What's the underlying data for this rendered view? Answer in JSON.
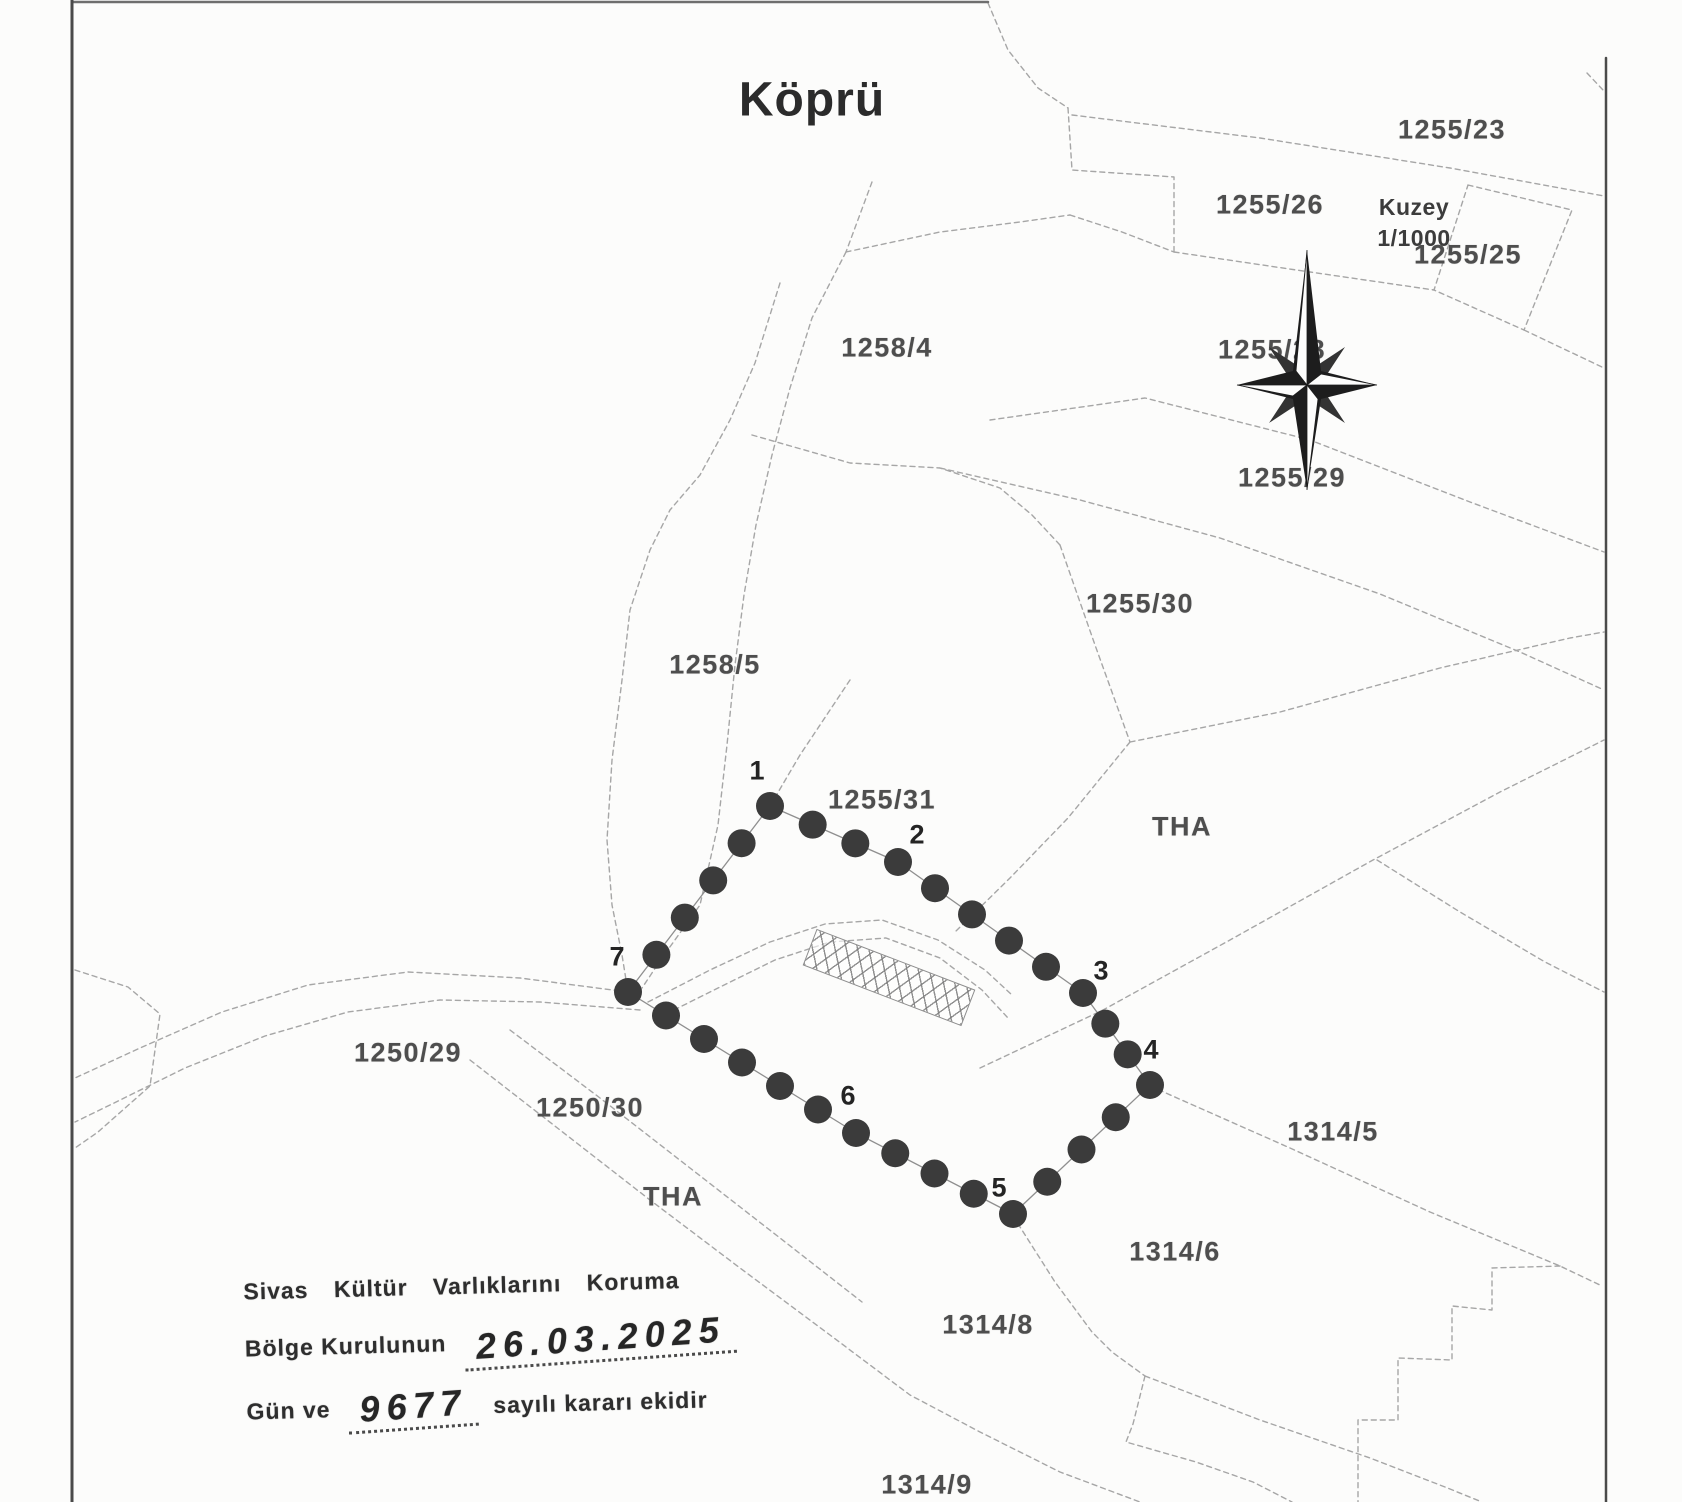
{
  "title": "Köprü",
  "compass": {
    "label": "Kuzey",
    "scale": "1/1000",
    "cx": 1307,
    "cy": 385,
    "label_x": 1414,
    "label_y": 192
  },
  "parcel_labels": [
    {
      "label": "1255/23",
      "x": 1452,
      "y": 130
    },
    {
      "label": "1255/26",
      "x": 1270,
      "y": 205
    },
    {
      "label": "1255/25",
      "x": 1468,
      "y": 255
    },
    {
      "label": "1255/28",
      "x": 1272,
      "y": 350
    },
    {
      "label": "1255/29",
      "x": 1292,
      "y": 478
    },
    {
      "label": "1255/30",
      "x": 1140,
      "y": 604
    },
    {
      "label": "1258/4",
      "x": 887,
      "y": 348
    },
    {
      "label": "1258/5",
      "x": 715,
      "y": 665
    },
    {
      "label": "1255/31",
      "x": 882,
      "y": 800
    },
    {
      "label": "THA",
      "x": 1182,
      "y": 827
    },
    {
      "label": "1250/29",
      "x": 408,
      "y": 1053
    },
    {
      "label": "1250/30",
      "x": 590,
      "y": 1108
    },
    {
      "label": "THA",
      "x": 673,
      "y": 1197
    },
    {
      "label": "1314/5",
      "x": 1333,
      "y": 1132
    },
    {
      "label": "1314/6",
      "x": 1175,
      "y": 1252
    },
    {
      "label": "1314/8",
      "x": 988,
      "y": 1325
    },
    {
      "label": "1314/9",
      "x": 927,
      "y": 1485
    }
  ],
  "site_polygon": {
    "vertices": [
      {
        "n": "1",
        "x": 770,
        "y": 806,
        "lx": 757,
        "ly": 771
      },
      {
        "n": "2",
        "x": 898,
        "y": 862,
        "lx": 917,
        "ly": 835
      },
      {
        "n": "3",
        "x": 1083,
        "y": 993,
        "lx": 1101,
        "ly": 971
      },
      {
        "n": "4",
        "x": 1150,
        "y": 1085,
        "lx": 1151,
        "ly": 1050
      },
      {
        "n": "5",
        "x": 1013,
        "y": 1214,
        "lx": 999,
        "ly": 1188
      },
      {
        "n": "6",
        "x": 856,
        "y": 1133,
        "lx": 848,
        "ly": 1096
      },
      {
        "n": "7",
        "x": 628,
        "y": 992,
        "lx": 617,
        "ly": 957
      }
    ],
    "mid_counts": [
      2,
      4,
      2,
      3,
      3,
      5,
      4
    ],
    "dot_radius": 14
  },
  "bridge": {
    "cx": 888,
    "cy": 976,
    "length": 168,
    "width": 37,
    "angle_deg": 21
  },
  "stamp": {
    "line1": "Sivas Kültür Varlıklarını Koruma",
    "line2_prefix": "Bölge Kurulunun",
    "line2_hand": "26.03.2025",
    "line3_prefix": "Gün ve",
    "line3_hand": "9677",
    "line3_suffix": "sayılı kararı ekidir",
    "x": 245,
    "y": 1272
  },
  "colors": {
    "paper": "#fcfcfb",
    "boundary_line": "#a6a6a6",
    "frame_line": "#4a4a4a",
    "dot": "#3b3b3b",
    "polygon_line": "#8f8f8f",
    "label_text": "#4e4e4e",
    "stamp_text": "#2e2e2e",
    "compass_dark": "#1d1d1d"
  },
  "frame": {
    "left": [
      [
        72,
        0
      ],
      [
        72,
        1502
      ]
    ],
    "top": [
      [
        72,
        2
      ],
      [
        988,
        2
      ]
    ],
    "right": [
      [
        1606,
        58
      ],
      [
        1606,
        1502
      ]
    ]
  },
  "boundaries": [
    [
      [
        988,
        3
      ],
      [
        1008,
        50
      ],
      [
        1038,
        88
      ],
      [
        1068,
        108
      ]
    ],
    [
      [
        1068,
        108
      ],
      [
        1072,
        170
      ],
      [
        1174,
        177
      ],
      [
        1174,
        252
      ]
    ],
    [
      [
        1072,
        115
      ],
      [
        1260,
        138
      ],
      [
        1450,
        168
      ],
      [
        1604,
        196
      ]
    ],
    [
      [
        1174,
        252
      ],
      [
        1310,
        272
      ],
      [
        1434,
        290
      ]
    ],
    [
      [
        1468,
        185
      ],
      [
        1572,
        210
      ],
      [
        1524,
        330
      ],
      [
        1434,
        290
      ],
      [
        1468,
        185
      ]
    ],
    [
      [
        1524,
        330
      ],
      [
        1604,
        368
      ]
    ],
    [
      [
        990,
        420
      ],
      [
        1145,
        398
      ],
      [
        1310,
        440
      ],
      [
        1470,
        502
      ],
      [
        1604,
        552
      ]
    ],
    [
      [
        940,
        468
      ],
      [
        1080,
        500
      ],
      [
        1220,
        538
      ],
      [
        1380,
        594
      ],
      [
        1520,
        652
      ],
      [
        1604,
        690
      ]
    ],
    [
      [
        1060,
        545
      ],
      [
        1095,
        645
      ],
      [
        1130,
        742
      ]
    ],
    [
      [
        1130,
        742
      ],
      [
        1280,
        712
      ],
      [
        1440,
        668
      ],
      [
        1570,
        638
      ],
      [
        1604,
        632
      ]
    ],
    [
      [
        1130,
        742
      ],
      [
        1068,
        818
      ],
      [
        1010,
        878
      ],
      [
        955,
        932
      ]
    ],
    [
      [
        780,
        283
      ],
      [
        755,
        363
      ],
      [
        730,
        420
      ],
      [
        700,
        475
      ],
      [
        670,
        510
      ],
      [
        650,
        550
      ],
      [
        630,
        610
      ],
      [
        622,
        680
      ],
      [
        612,
        760
      ],
      [
        607,
        840
      ],
      [
        612,
        905
      ],
      [
        622,
        955
      ],
      [
        628,
        992
      ]
    ],
    [
      [
        846,
        252
      ],
      [
        812,
        318
      ],
      [
        790,
        388
      ],
      [
        772,
        455
      ],
      [
        756,
        525
      ],
      [
        744,
        595
      ],
      [
        735,
        665
      ],
      [
        727,
        745
      ],
      [
        718,
        825
      ],
      [
        700,
        905
      ],
      [
        662,
        958
      ],
      [
        642,
        988
      ]
    ],
    [
      [
        872,
        182
      ],
      [
        846,
        252
      ]
    ],
    [
      [
        846,
        252
      ],
      [
        940,
        232
      ],
      [
        1020,
        222
      ],
      [
        1070,
        215
      ]
    ],
    [
      [
        1070,
        215
      ],
      [
        1122,
        232
      ],
      [
        1174,
        252
      ]
    ],
    [
      [
        752,
        435
      ],
      [
        850,
        463
      ],
      [
        940,
        468
      ],
      [
        1000,
        488
      ],
      [
        1032,
        515
      ],
      [
        1060,
        545
      ]
    ],
    [
      [
        850,
        680
      ],
      [
        830,
        710
      ],
      [
        800,
        755
      ],
      [
        770,
        806
      ]
    ],
    [
      [
        628,
        992
      ],
      [
        520,
        978
      ],
      [
        408,
        972
      ],
      [
        308,
        985
      ],
      [
        222,
        1012
      ],
      [
        140,
        1048
      ],
      [
        75,
        1078
      ]
    ],
    [
      [
        640,
        1010
      ],
      [
        540,
        1002
      ],
      [
        440,
        1000
      ],
      [
        348,
        1012
      ],
      [
        265,
        1036
      ],
      [
        185,
        1068
      ],
      [
        110,
        1105
      ],
      [
        75,
        1122
      ]
    ],
    [
      [
        75,
        970
      ],
      [
        128,
        987
      ],
      [
        160,
        1014
      ],
      [
        150,
        1086
      ],
      [
        98,
        1132
      ],
      [
        75,
        1148
      ]
    ],
    [
      [
        470,
        1060
      ],
      [
        560,
        1130
      ],
      [
        650,
        1200
      ],
      [
        740,
        1268
      ],
      [
        830,
        1335
      ],
      [
        910,
        1395
      ],
      [
        980,
        1432
      ],
      [
        1060,
        1472
      ],
      [
        1140,
        1502
      ]
    ],
    [
      [
        510,
        1030
      ],
      [
        600,
        1098
      ],
      [
        690,
        1168
      ],
      [
        780,
        1238
      ],
      [
        862,
        1302
      ]
    ],
    [
      [
        1013,
        1216
      ],
      [
        1055,
        1282
      ],
      [
        1092,
        1332
      ],
      [
        1112,
        1352
      ],
      [
        1145,
        1376
      ]
    ],
    [
      [
        1145,
        1376
      ],
      [
        1133,
        1424
      ],
      [
        1126,
        1442
      ],
      [
        1196,
        1462
      ],
      [
        1253,
        1482
      ],
      [
        1292,
        1502
      ]
    ],
    [
      [
        1145,
        1376
      ],
      [
        1260,
        1420
      ],
      [
        1370,
        1458
      ],
      [
        1445,
        1487
      ],
      [
        1482,
        1502
      ]
    ],
    [
      [
        1150,
        1086
      ],
      [
        1290,
        1148
      ],
      [
        1430,
        1212
      ],
      [
        1560,
        1266
      ],
      [
        1602,
        1286
      ]
    ],
    [
      [
        1560,
        1266
      ],
      [
        1492,
        1268
      ],
      [
        1492,
        1310
      ],
      [
        1452,
        1306
      ],
      [
        1452,
        1360
      ],
      [
        1398,
        1358
      ],
      [
        1398,
        1420
      ],
      [
        1358,
        1420
      ],
      [
        1358,
        1502
      ]
    ],
    [
      [
        980,
        1068
      ],
      [
        1103,
        1010
      ],
      [
        1230,
        940
      ],
      [
        1373,
        860
      ],
      [
        1500,
        792
      ],
      [
        1604,
        740
      ]
    ],
    [
      [
        1377,
        860
      ],
      [
        1460,
        912
      ],
      [
        1545,
        962
      ],
      [
        1604,
        992
      ]
    ],
    [
      [
        648,
        1002
      ],
      [
        710,
        970
      ],
      [
        770,
        942
      ],
      [
        825,
        924
      ],
      [
        882,
        920
      ],
      [
        938,
        940
      ],
      [
        985,
        970
      ],
      [
        1012,
        995
      ]
    ],
    [
      [
        658,
        1018
      ],
      [
        718,
        988
      ],
      [
        775,
        960
      ],
      [
        830,
        942
      ],
      [
        886,
        938
      ],
      [
        940,
        958
      ],
      [
        982,
        990
      ],
      [
        1008,
        1018
      ]
    ],
    [
      [
        1587,
        73
      ],
      [
        1603,
        90
      ]
    ]
  ]
}
